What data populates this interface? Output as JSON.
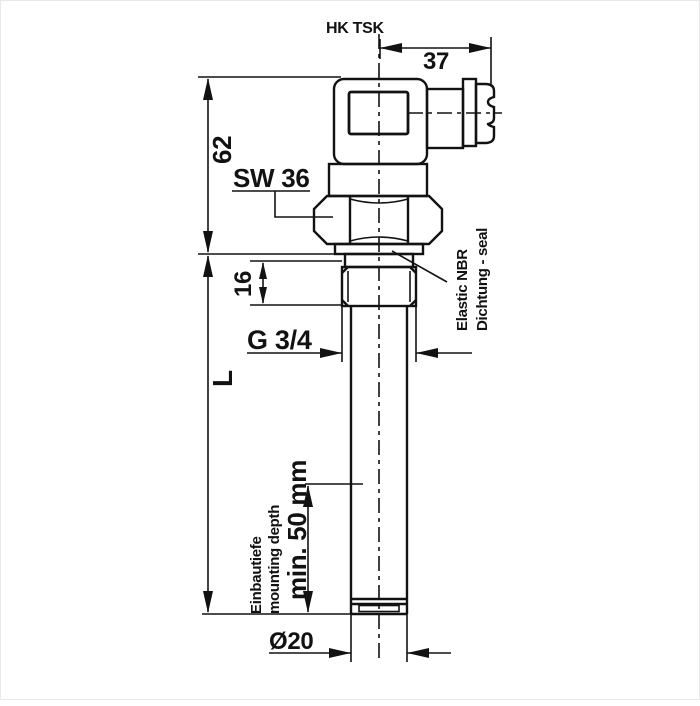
{
  "drawing": {
    "type_label": "HK TSK",
    "dims": {
      "connector_width": "37",
      "head_height": "62",
      "wrench_size": "SW 36",
      "thread_length": "16",
      "thread_size": "G 3/4",
      "probe_length": "L",
      "mounting_depth": "min. 50 mm",
      "mounting_depth_label_de": "Einbautiefe",
      "mounting_depth_label_en": "mounting depth",
      "probe_diameter": "Ø20",
      "seal_line1": "Elastic NBR",
      "seal_line2": "Dichtung - seal"
    },
    "colors": {
      "line": "#121212",
      "background": "#ffffff"
    }
  }
}
